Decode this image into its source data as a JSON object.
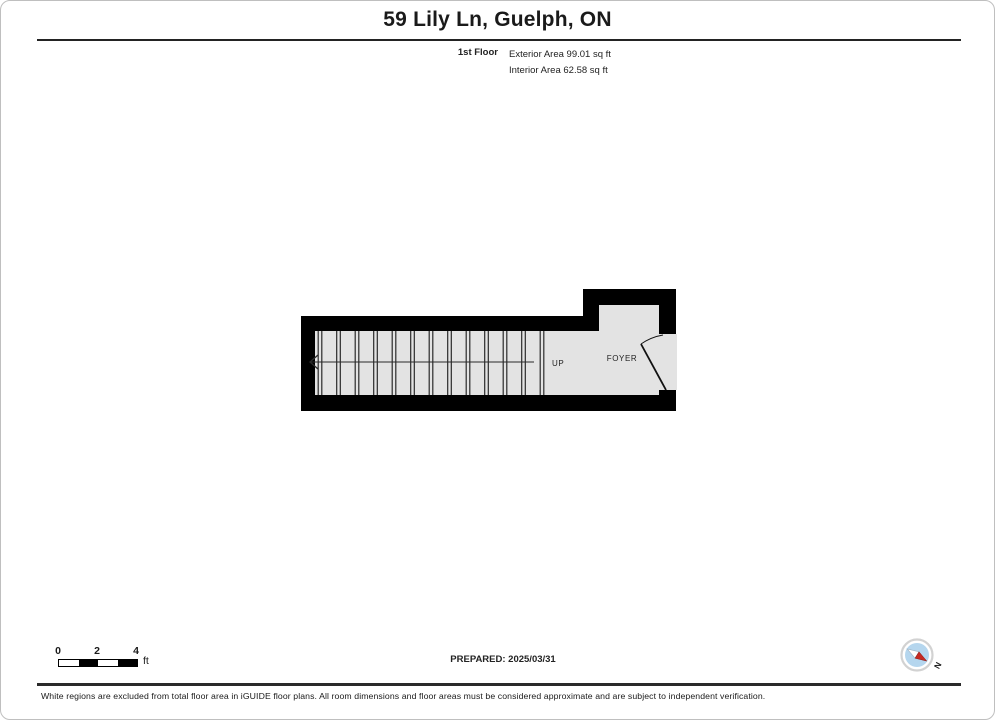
{
  "header": {
    "title": "59 Lily Ln, Guelph, ON",
    "floor_label": "1st Floor",
    "exterior_area": "Exterior Area 99.01 sq ft",
    "interior_area": "Interior Area 62.58 sq ft"
  },
  "floorplan": {
    "labels": {
      "up": "UP",
      "foyer": "FOYER"
    },
    "stairs": {
      "separators": 13
    },
    "colors": {
      "wall": "#000000",
      "floor": "#e3e3e3",
      "line": "#2a2a2a"
    }
  },
  "footer_bar": {
    "scale": {
      "ticks": [
        "0",
        "2",
        "4"
      ],
      "unit": "ft"
    },
    "prepared": "PREPARED: 2025/03/31",
    "compass": {
      "label": "N",
      "colors": {
        "ring": "#d2d2d2",
        "face": "#b5d6ee",
        "needle_north": "#c62a22",
        "needle_south": "#ffffff"
      }
    }
  },
  "disclaimer": "White regions are excluded from total floor area in iGUIDE floor plans. All room dimensions and floor areas must be considered approximate and are subject to independent verification."
}
